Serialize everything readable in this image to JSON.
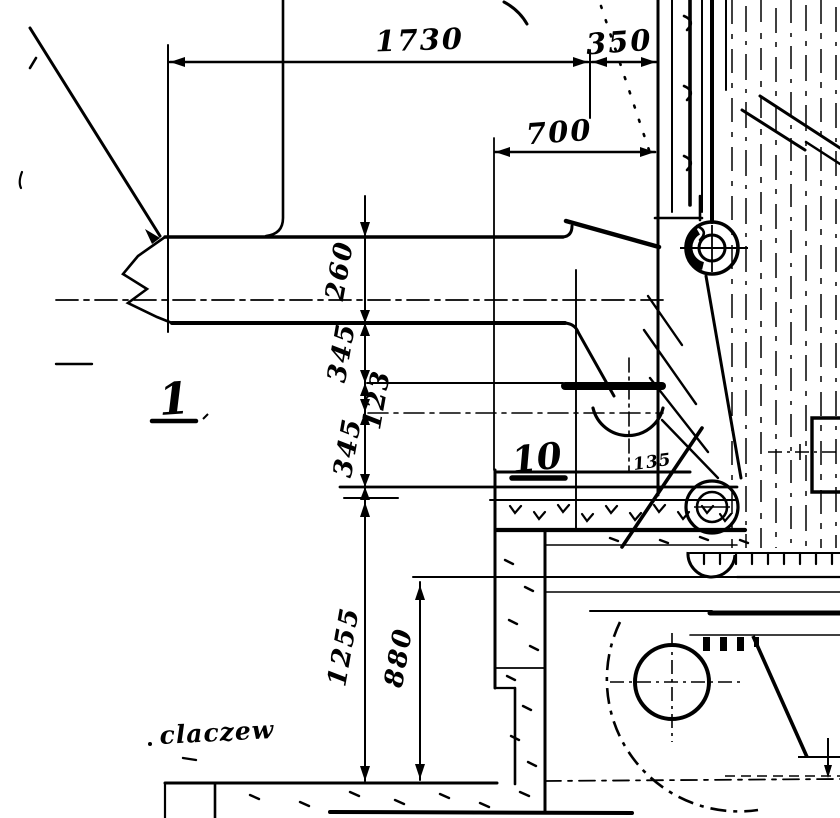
{
  "drawing": {
    "dimensions": {
      "d1730": "1730",
      "d350": "350",
      "d700": "700",
      "d260": "260",
      "d345a": "345",
      "d123": "123",
      "d345b": "345",
      "d1255": "1255",
      "d880": "880"
    },
    "labels": {
      "detail1": "1",
      "detail10": "10",
      "note135": "135",
      "annotation": "claczew"
    },
    "colors": {
      "ink": "#000000",
      "paper": "#ffffff"
    }
  }
}
